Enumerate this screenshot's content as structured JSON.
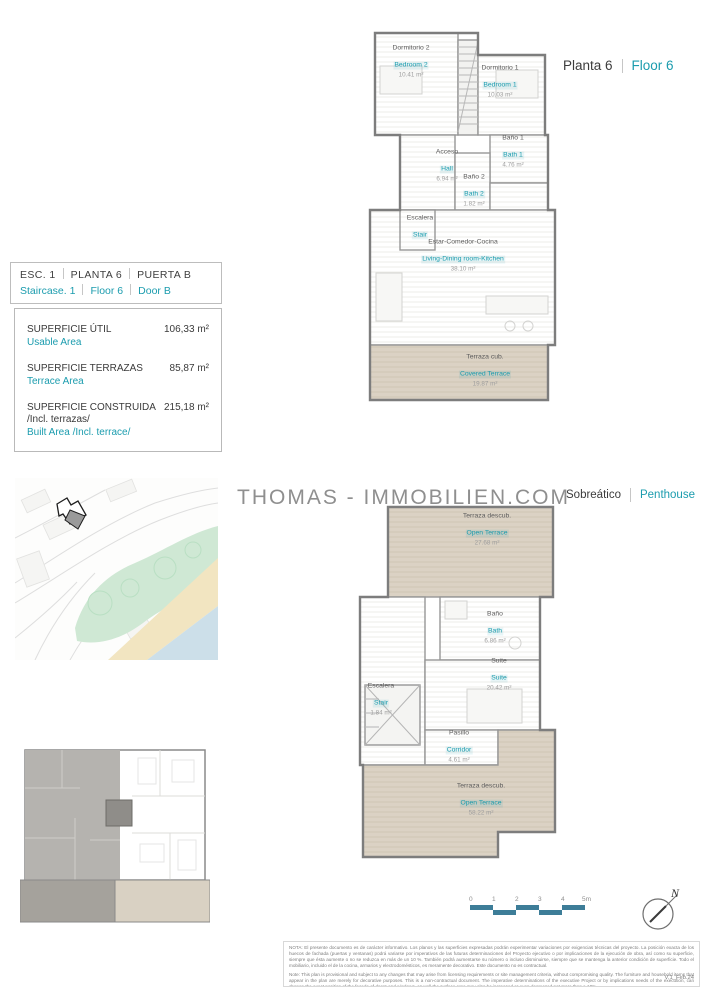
{
  "colors": {
    "accent": "#1b9cae",
    "terrace_fill": "#dbd2c4",
    "scalebar_blue": "#3d7d98"
  },
  "watermark": "THOMAS - IMMOBILIEN.COM",
  "header": {
    "line1": [
      "ESC. 1",
      "PLANTA 6",
      "PUERTA B"
    ],
    "line2": [
      "Staircase. 1",
      "Floor 6",
      "Door B"
    ]
  },
  "info_box": {
    "rows": [
      {
        "label_es": "SUPERFICIE ÚTIL",
        "label_en": "Usable Area",
        "value": "106,33 m²"
      },
      {
        "label_es": "SUPERFICIE TERRAZAS",
        "label_en": "Terrace Area",
        "value": "85,87 m²"
      },
      {
        "label_es": "SUPERFICIE CONSTRUIDA",
        "label_es2": "/Incl. terrazas/",
        "label_en": "Built Area /Incl. terrace/",
        "value": "215,18 m²"
      }
    ]
  },
  "plans": {
    "planta6": {
      "title_es": "Planta 6",
      "title_en": "Floor 6",
      "rooms": [
        {
          "es": "Dormitorio 2",
          "en": "Bedroom 2",
          "area": "10.41 m²"
        },
        {
          "es": "Dormitorio 1",
          "en": "Bedroom 1",
          "area": "10.03 m²"
        },
        {
          "es": "Acceso",
          "en": "Hall",
          "area": "6.94 m²"
        },
        {
          "es": "Baño 1",
          "en": "Bath 1",
          "area": "4.76 m²"
        },
        {
          "es": "Baño 2",
          "en": "Bath 2",
          "area": "1.82 m²"
        },
        {
          "es": "Escalera",
          "en": "Stair",
          "area": ""
        },
        {
          "es": "Estar-Comedor-Cocina",
          "en": "Living-Dining room-Kitchen",
          "area": "38.10 m²"
        },
        {
          "es": "Terraza cub.",
          "en": "Covered Terrace",
          "area": "19.87 m²"
        }
      ]
    },
    "penthouse": {
      "title_es": "Sobreático",
      "title_en": "Penthouse",
      "rooms": [
        {
          "es": "Terraza descub.",
          "en": "Open Terrace",
          "area": "27.68 m²"
        },
        {
          "es": "Baño",
          "en": "Bath",
          "area": "6.86 m²"
        },
        {
          "es": "Suite",
          "en": "Suite",
          "area": "20.42 m²"
        },
        {
          "es": "Escalera",
          "en": "Stair",
          "area": "1.84 m²"
        },
        {
          "es": "Pasillo",
          "en": "Corridor",
          "area": "4.61 m²"
        },
        {
          "es": "Terraza descub.",
          "en": "Open Terrace",
          "area": "58.22 m²"
        }
      ]
    }
  },
  "scalebar": {
    "labels": [
      "0",
      "1",
      "2",
      "3",
      "4",
      "5m"
    ]
  },
  "north": {
    "label": "N"
  },
  "disclaimer": {
    "note_es": "NOTA:  El presente documento es de carácter informativo. Los planos y las superficies expresadas podrán experimentar variaciones por exigencias técnicas del proyecto. La posición exacta de los huecos de fachada (puertas y ventanas) podrá variarse por imperativos de las futuras determinaciones del Proyecto ejecutivo o por implicaciones de la ejecución de obra, así como su superficie, siempre que ésta aumente o no se reduzca en más de un 10 %. También podrá aumentarse su número o incluso disminuirse, siempre que se mantenga la anterior condición de superficie. Todo el mobiliario, incluido el de la cocina, armarios y electrodomésticos, es meramente decorativo. Este documento no es contractual.",
    "note_en": "Note: This plan is provisional and subject to any changes that may arise from licensing requirements or site management criteria, without compromising quality. The furniture and household items that appear in the plan are merely for decorative purposes. This is a non-contractual document. The imperative determinations of the executive Project or by implications needs of the execution, can change the exact position of the facade of doors and windows, as well the surface area may also be increased or even decreased not more than a 10%.",
    "version": "V.1_Feb.24"
  }
}
